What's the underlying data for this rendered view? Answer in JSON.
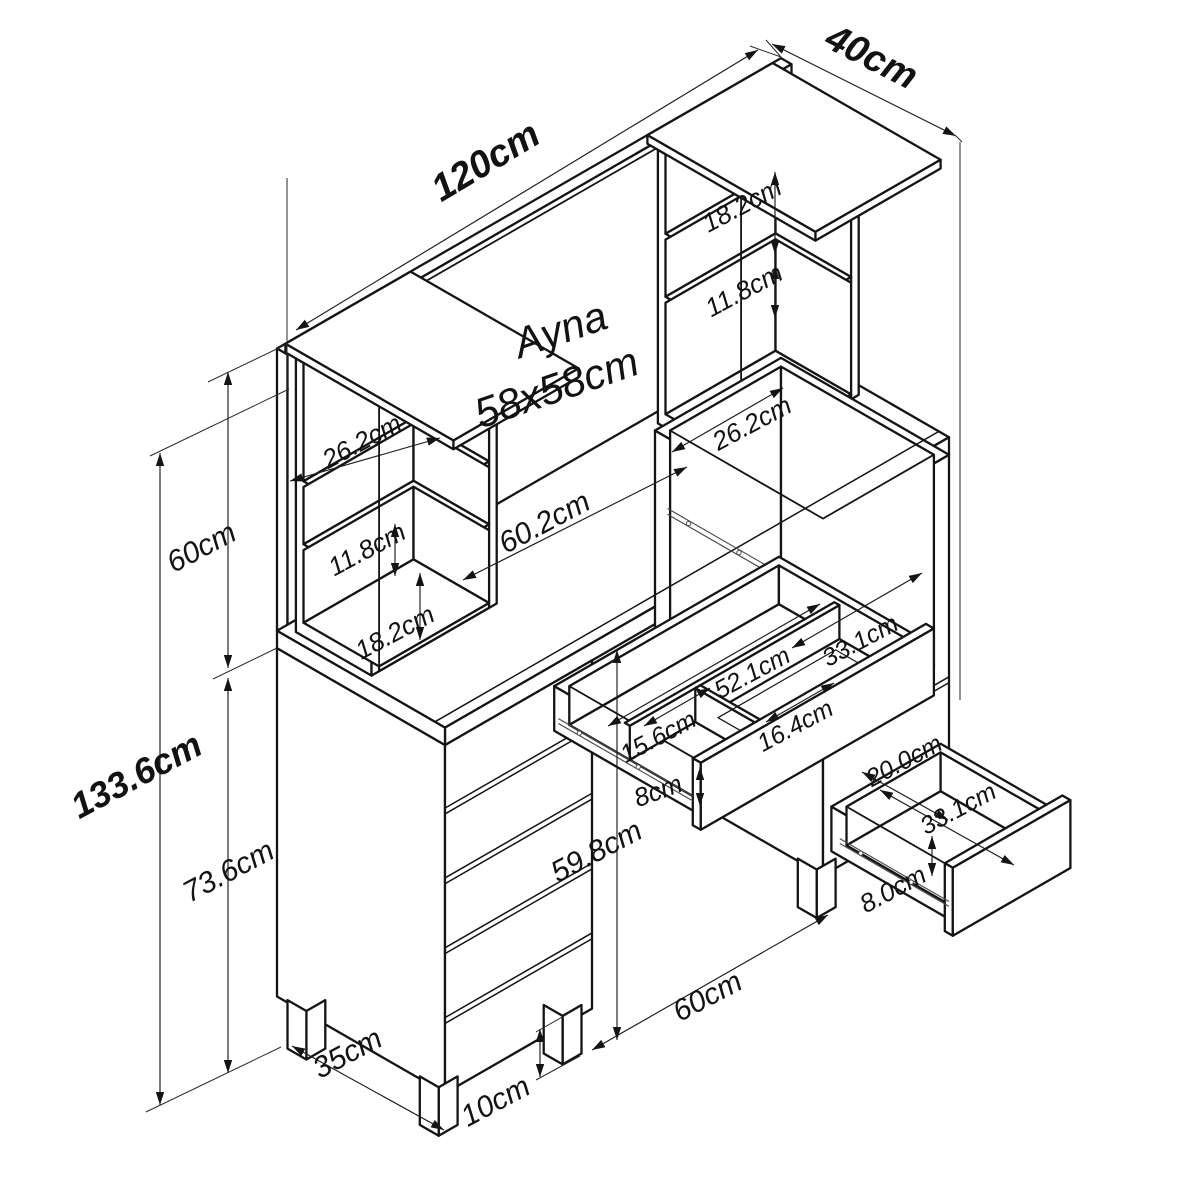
{
  "product": {
    "mirror_line1": "Ayna",
    "mirror_line2": "58x58cm"
  },
  "dims": {
    "total_width": "120cm",
    "total_depth": "40cm",
    "upper_section_height": "60cm",
    "total_height": "133.6cm",
    "lower_section_height": "73.6cm",
    "knee_clearance_height": "59.8cm",
    "knee_space_width": "60cm",
    "base_depth": "35cm",
    "leg_height": "10cm",
    "desk_span": "60.2cm",
    "left_shelf_top": "26.2cm",
    "left_shelf_middle": "11.8cm",
    "left_shelf_bottom": "18.2cm",
    "right_shelf_top": "18.2cm",
    "right_shelf_middle": "11.8cm",
    "right_compartment_width": "26.2cm",
    "center_drawer_left_section": "15.6cm",
    "center_drawer_inner_width": "52.1cm",
    "center_drawer_right_section": "33.1cm",
    "center_drawer_front_section": "16.4cm",
    "center_drawer_depth": "8cm",
    "side_drawer_inner_width": "20.0cm",
    "side_drawer_inner_length": "33.1cm",
    "side_drawer_depth": "8.0cm"
  }
}
